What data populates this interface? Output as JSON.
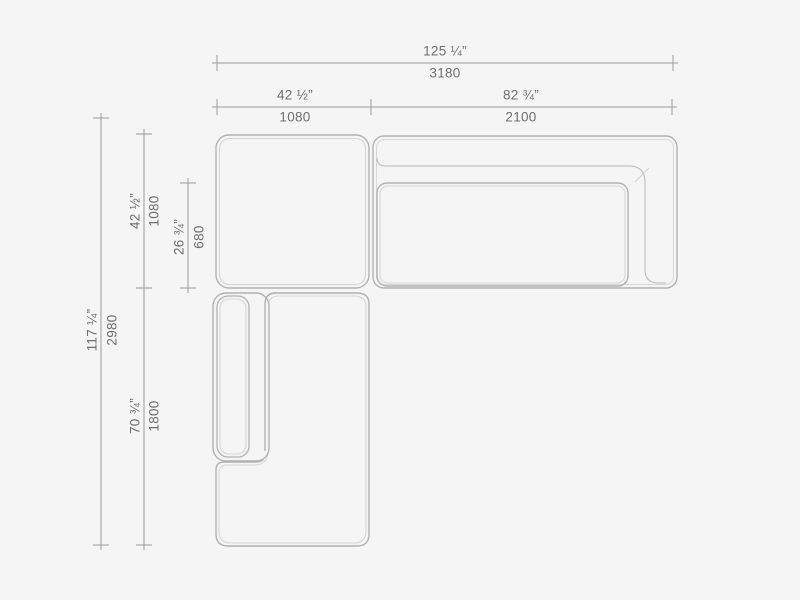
{
  "drawing": {
    "title": "Sectional sofa top-view dimension drawing",
    "units": [
      "inches",
      "millimeters"
    ]
  },
  "colors": {
    "background": "#f5f5f5",
    "outline": "#b2b2b2",
    "outline_light": "#d6d6d6",
    "dimension_line": "#9c9c9c",
    "label_text": "#6e6e6e"
  },
  "dimensions": {
    "overall_width": {
      "imperial": "125 ¼”",
      "metric": "3180"
    },
    "left_width": {
      "imperial": "42 ½”",
      "metric": "1080"
    },
    "right_width": {
      "imperial": "82 ¾”",
      "metric": "2100"
    },
    "overall_depth": {
      "imperial": "117 ¼”",
      "metric": "2980"
    },
    "top_depth": {
      "imperial": "42 ½”",
      "metric": "1080"
    },
    "seat_depth": {
      "imperial": "26 ¾”",
      "metric": "680"
    },
    "chaise_length": {
      "imperial": "70 ¾”",
      "metric": "1800"
    }
  }
}
